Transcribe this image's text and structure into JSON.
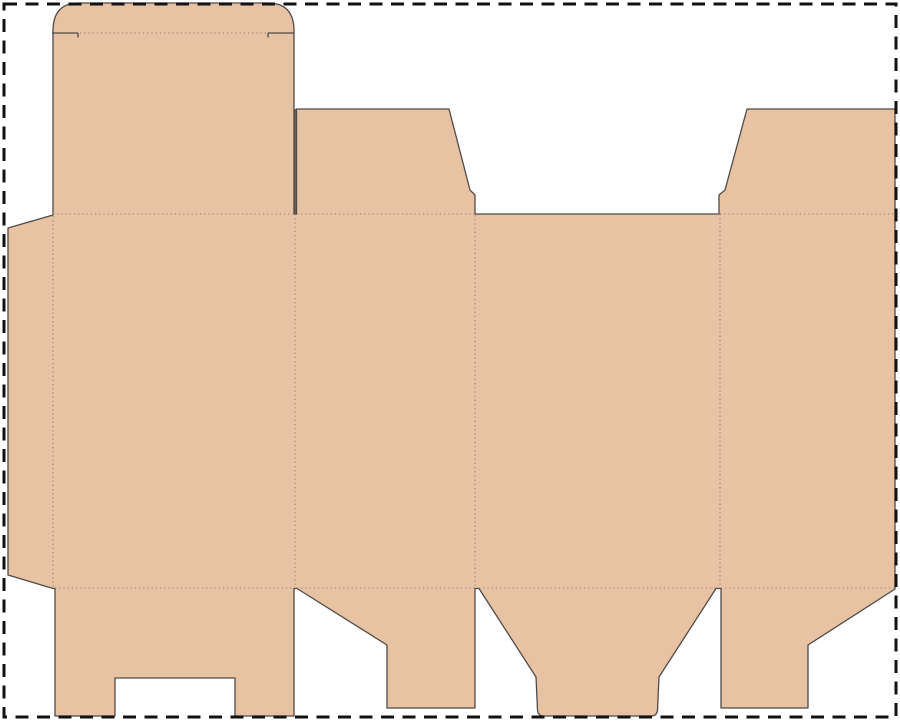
{
  "canvas": {
    "width": 900,
    "height": 721,
    "background": "#ffffff"
  },
  "colors": {
    "board_fill": "#e7c3a3",
    "cut_line": "#4f4b48",
    "fold_line": "#8c8279",
    "page_border": "#121212"
  },
  "page_border": {
    "inset": 4,
    "stroke_width": 3,
    "dash_pattern": "13 8.5"
  },
  "dieline": {
    "outline": {
      "name": "dieline-outline",
      "path": "M 79 3 L 268 3 Q 294 3 294 31 L 294 214 L 296.5 214 L 296.5 109 L 449 109 L 470 190 L 475 195 L 475 214 L 719 214 L 719 195 L 725 190 L 747 109 L 895 109 L 895 589 L 808 645 L 808 708 L 721 708 L 721 588.5 L 716 588.5 L 659 677 L 657.5 710 Q 657 716 651 716 L 544 716 Q 538 716 537.5 710 L 536 677 L 479 588.5 L 475 588.5 L 475 708 L 387 708 L 387 645 L 297 588.5 L 294 588.5 L 294 716 L 235 716 L 235 678 L 115 678 L 115 716 L 55 716 L 55 588.5 L 53 588.5 L 8 575 L 8 228 L 53 215 L 53 31 Q 53 3 79 3 Z"
    },
    "slit_cuts": [
      {
        "name": "lid-shoulder-cut-left",
        "x1": 52,
        "y1": 33,
        "x2": 78,
        "y2": 33
      },
      {
        "name": "lid-shoulder-tick-left",
        "x1": 78,
        "y1": 33,
        "x2": 78,
        "y2": 37.5
      },
      {
        "name": "lid-shoulder-cut-right",
        "x1": 268,
        "y1": 33,
        "x2": 294,
        "y2": 33
      },
      {
        "name": "lid-shoulder-tick-right",
        "x1": 268,
        "y1": 33,
        "x2": 268,
        "y2": 37.5
      },
      {
        "name": "lid-sideflap-slit",
        "x1": 295.2,
        "y1": 109,
        "x2": 295.2,
        "y2": 214
      }
    ],
    "fold_lines": [
      {
        "name": "lid-tuck-fold",
        "x1": 80,
        "y1": 33,
        "x2": 266,
        "y2": 33
      },
      {
        "name": "lid-base-fold",
        "x1": 53,
        "y1": 214,
        "x2": 294,
        "y2": 214
      },
      {
        "name": "top-flap-b-fold",
        "x1": 297,
        "y1": 214,
        "x2": 474,
        "y2": 214
      },
      {
        "name": "top-flap-d-fold",
        "x1": 720,
        "y1": 214,
        "x2": 894,
        "y2": 214
      },
      {
        "name": "glue-flap-fold",
        "x1": 53,
        "y1": 216,
        "x2": 53,
        "y2": 588
      },
      {
        "name": "panel-a-b-fold",
        "x1": 295,
        "y1": 214,
        "x2": 295,
        "y2": 588
      },
      {
        "name": "panel-b-c-fold",
        "x1": 475,
        "y1": 215,
        "x2": 475,
        "y2": 588
      },
      {
        "name": "panel-c-d-fold",
        "x1": 720,
        "y1": 214,
        "x2": 720,
        "y2": 588
      },
      {
        "name": "bottom-flap-a-fold",
        "x1": 55,
        "y1": 588,
        "x2": 294,
        "y2": 588
      },
      {
        "name": "bottom-flap-b-fold",
        "x1": 297,
        "y1": 588,
        "x2": 475,
        "y2": 588
      },
      {
        "name": "bottom-flap-c-fold",
        "x1": 479,
        "y1": 588,
        "x2": 716,
        "y2": 588
      },
      {
        "name": "bottom-flap-d-fold",
        "x1": 721,
        "y1": 588,
        "x2": 894,
        "y2": 588
      }
    ]
  }
}
